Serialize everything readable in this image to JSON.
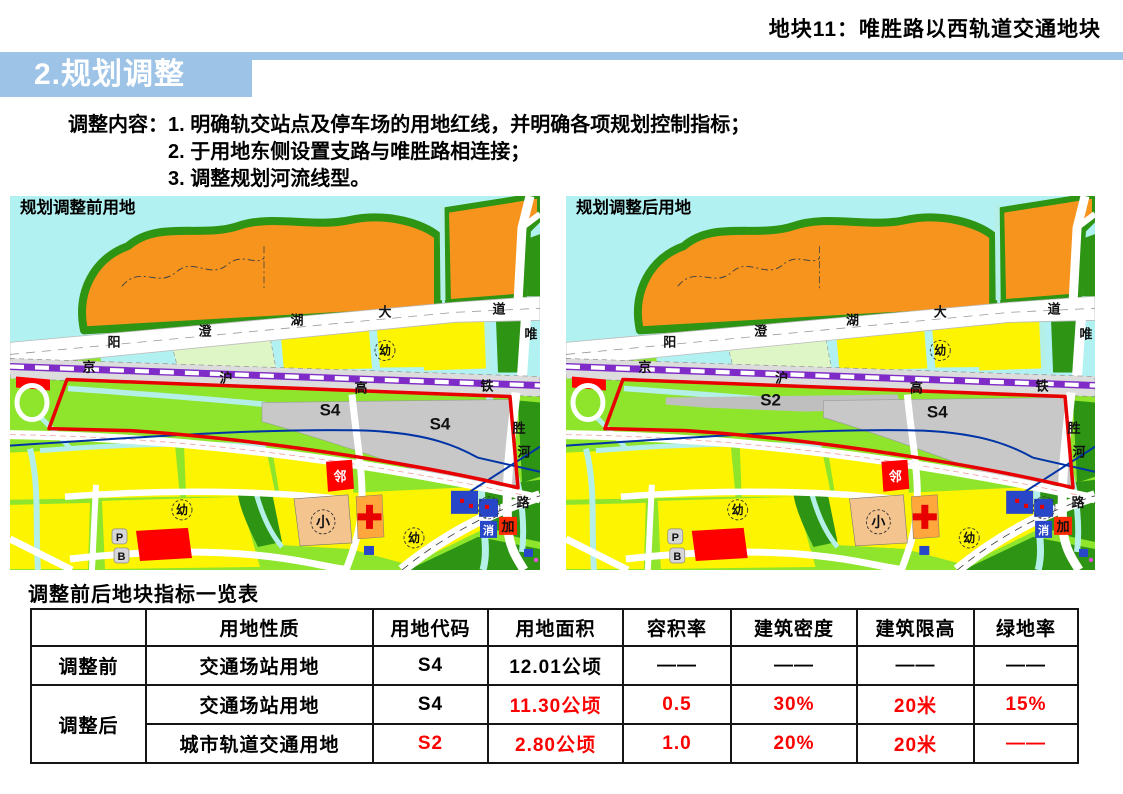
{
  "page_title": "地块11：唯胜路以西轨道交通地块",
  "section": {
    "header": "2.规划调整"
  },
  "adjust": {
    "label": "调整内容：",
    "items": [
      "1. 明确轨交站点及停车场的用地红线，并明确各项规划控制指标；",
      "2. 于用地东侧设置支路与唯胜路相连接；",
      "3. 调整规划河流线型。"
    ]
  },
  "maps": {
    "before": {
      "title": "规划调整前用地",
      "zones": [
        "S4",
        "S4"
      ]
    },
    "after": {
      "title": "规划调整后用地",
      "zones": [
        "S2",
        "S4"
      ]
    }
  },
  "map_labels": {
    "avenue": [
      "阳",
      "澄",
      "湖",
      "大",
      "道"
    ],
    "weisheng_road": [
      "唯",
      "胜",
      "路"
    ],
    "river": "河",
    "railway": [
      "京",
      "沪",
      "高",
      "铁"
    ],
    "kindergarten": "幼",
    "neighborhood": "邻",
    "primary_school": "小",
    "fire_station": "消",
    "gas_station": "加",
    "parking": "P",
    "bus": "B"
  },
  "table": {
    "title": "调整前后地块指标一览表",
    "headers": [
      "",
      "用地性质",
      "用地代码",
      "用地面积",
      "容积率",
      "建筑密度",
      "建筑限高",
      "绿地率"
    ],
    "rows": [
      {
        "group": "调整前",
        "rowspan": 1,
        "cells": [
          {
            "t": "交通场站用地"
          },
          {
            "t": "S4"
          },
          {
            "t": "12.01公顷"
          },
          {
            "t": "——"
          },
          {
            "t": "——"
          },
          {
            "t": "——"
          },
          {
            "t": "——"
          }
        ]
      },
      {
        "group": "调整后",
        "rowspan": 2,
        "cells": [
          {
            "t": "交通场站用地"
          },
          {
            "t": "S4"
          },
          {
            "t": "11.30公顷",
            "red": true
          },
          {
            "t": "0.5",
            "red": true
          },
          {
            "t": "30%",
            "red": true
          },
          {
            "t": "20米",
            "red": true
          },
          {
            "t": "15%",
            "red": true
          }
        ]
      },
      {
        "cells": [
          {
            "t": "城市轨道交通用地"
          },
          {
            "t": "S2",
            "red": true
          },
          {
            "t": "2.80公顷",
            "red": true
          },
          {
            "t": "1.0",
            "red": true
          },
          {
            "t": "20%",
            "red": true
          },
          {
            "t": "20米",
            "red": true
          },
          {
            "t": "——",
            "red": true
          }
        ]
      }
    ]
  },
  "colors": {
    "header_blue": "#9DC3E6",
    "highlight_red": "#FD0000",
    "boundary_red": "#E80000",
    "zone_gray": "#C8C8C8",
    "zone_strip_gray": "#BFBFBF",
    "residential_yellow": "#FCF400",
    "green_space": "#8EE52C",
    "park_green": "#2E9413",
    "hill_orange": "#F7941D",
    "water_cyan": "#B2F1F1",
    "channel_cyan": "#B4F0E8",
    "railway_purple": "#7E2BC8",
    "river_blue": "#0034A6"
  }
}
